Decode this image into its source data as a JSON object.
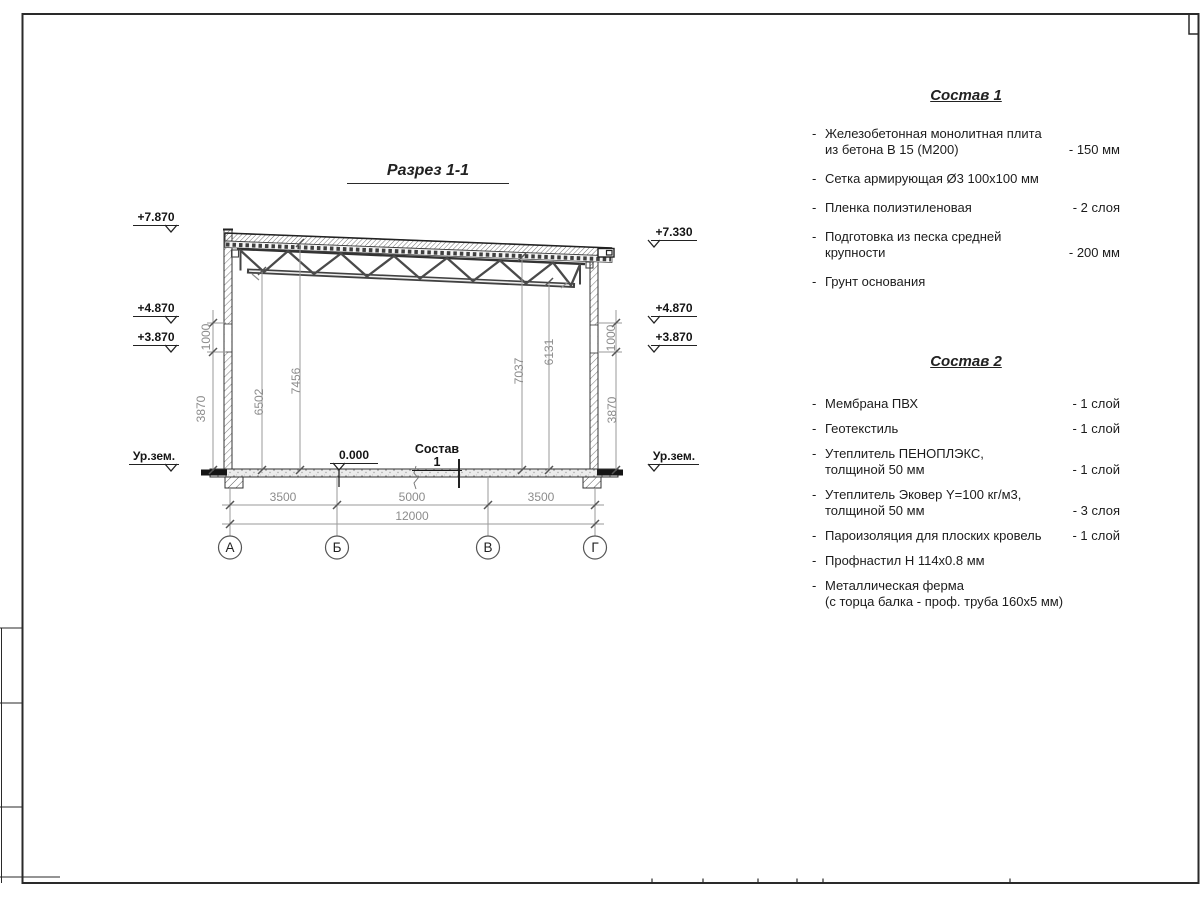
{
  "bullet": "-",
  "drawing": {
    "title": "Разрез 1-1",
    "zero_level": "0.000",
    "floor_label": "Состав 1",
    "elevations": {
      "left_top": "+7.870",
      "left_mid1": "+4.870",
      "left_mid2": "+3.870",
      "left_ground": "Ур.зем.",
      "right_top": "+7.330",
      "right_mid1": "+4.870",
      "right_mid2": "+3.870",
      "right_ground": "Ур.зем."
    },
    "dimensions": {
      "interior_left_1": "6502",
      "interior_left_2": "7456",
      "interior_right_1": "7037",
      "interior_right_2": "6131",
      "wall_left_upper": "1000",
      "wall_left_lower": "3870",
      "wall_right_upper": "1000",
      "wall_right_lower": "3870",
      "span_1": "3500",
      "span_2": "5000",
      "span_3": "3500",
      "total": "12000"
    },
    "axes": {
      "a1": "А",
      "a2": "Б",
      "a3": "В",
      "a4": "Г"
    }
  },
  "comp1": {
    "title": "Состав 1",
    "items": [
      {
        "text": "Железобетонная  монолитная плита\nиз бетона В 15 (М200)",
        "value": "- 150 мм"
      },
      {
        "text": "Сетка армирующая Ø3 100x100 мм",
        "value": ""
      },
      {
        "text": "Пленка полиэтиленовая",
        "value": "- 2 слоя"
      },
      {
        "text": "Подготовка из песка средней\nкрупности",
        "value": "- 200 мм"
      },
      {
        "text": "Грунт основания",
        "value": ""
      }
    ]
  },
  "comp2": {
    "title": "Состав 2",
    "items": [
      {
        "text": "Мембрана ПВХ",
        "value": "- 1 слой"
      },
      {
        "text": "Геотекстиль",
        "value": "- 1 слой"
      },
      {
        "text": "Утеплитель ПЕНОПЛЭКС,\nтолщиной 50 мм",
        "value": "- 1 слой"
      },
      {
        "text": "Утеплитель Эковер Y=100 кг/м3,\nтолщиной 50 мм",
        "value": "- 3 слоя"
      },
      {
        "text": "Пароизоляция для плоских кровель",
        "value": "- 1 слой"
      },
      {
        "text": "Профнастил Н 114x0.8 мм",
        "value": ""
      },
      {
        "text": "Металлическая ферма\n(с торца балка - проф. труба 160x5 мм)",
        "value": ""
      }
    ]
  }
}
